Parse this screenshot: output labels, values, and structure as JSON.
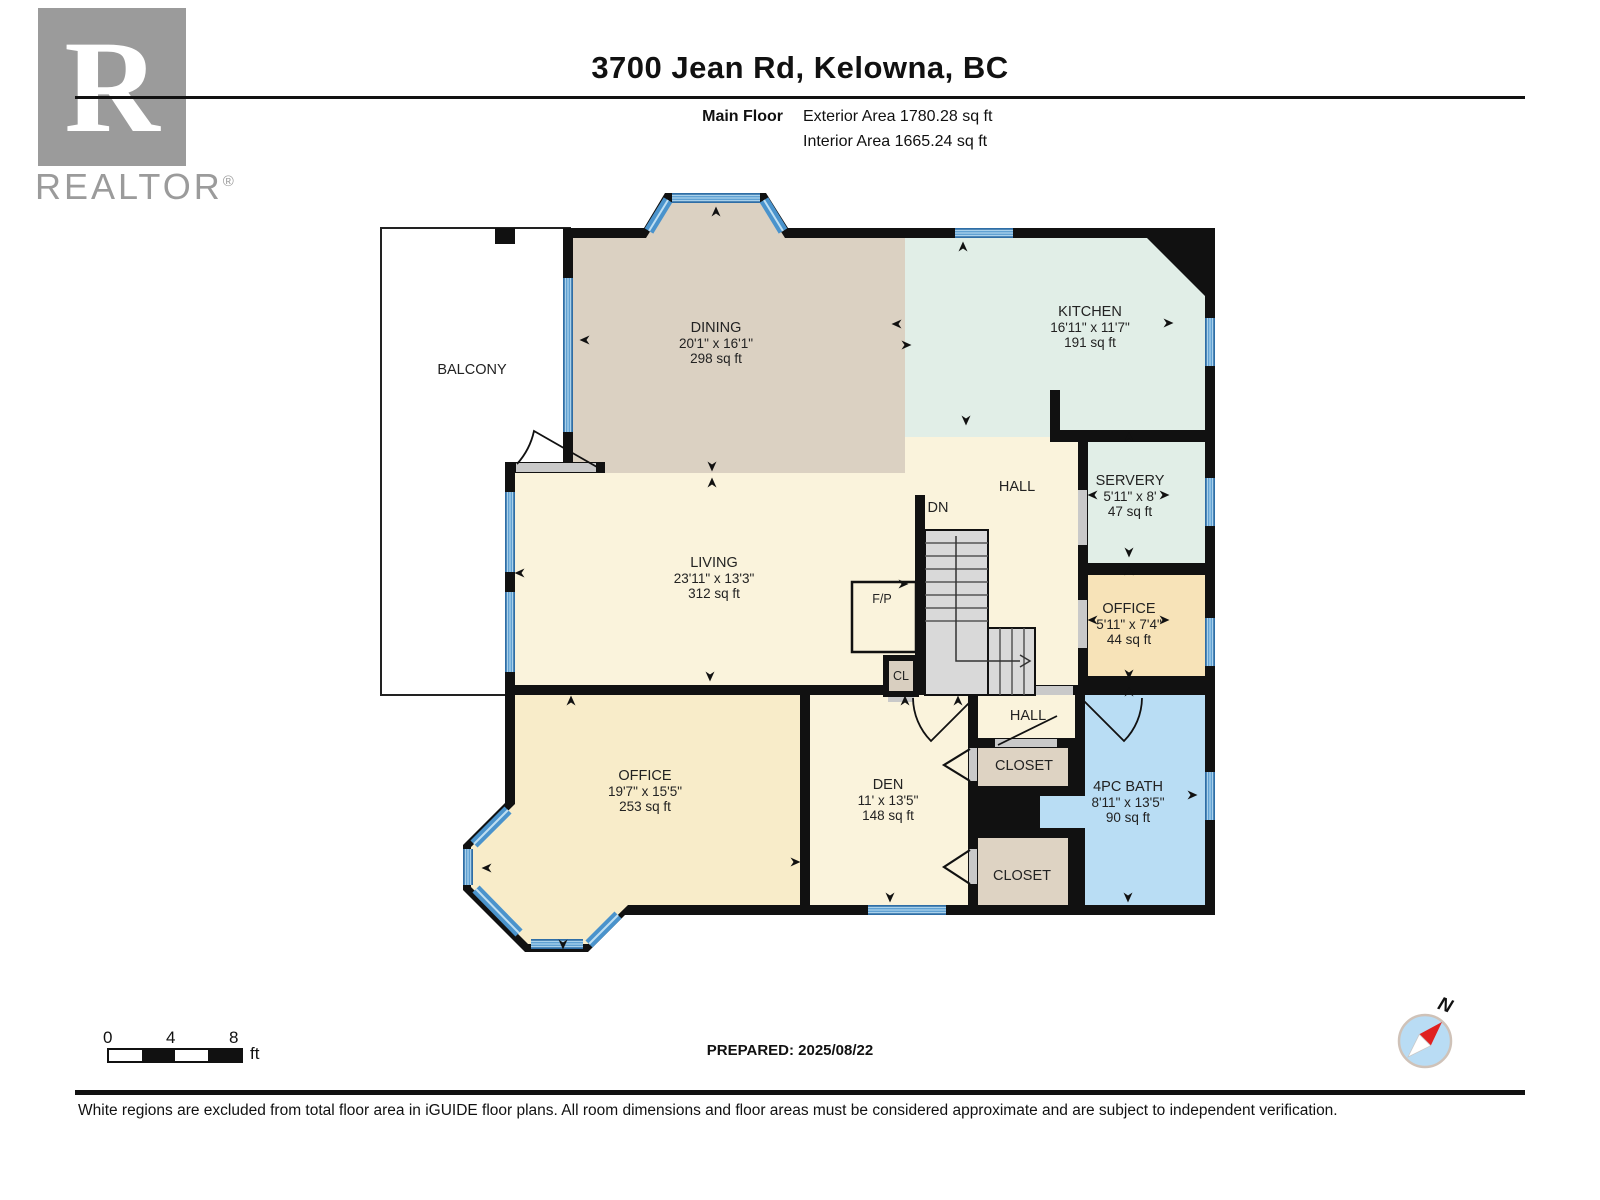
{
  "header": {
    "title": "3700 Jean Rd, Kelowna, BC",
    "floor_label": "Main Floor",
    "exterior_area": "Exterior Area 1780.28 sq ft",
    "interior_area": "Interior Area 1665.24 sq ft"
  },
  "watermark": {
    "letter": "R",
    "word": "REALTOR",
    "reg": "®"
  },
  "plan": {
    "rooms": [
      {
        "name": "BALCONY",
        "dims": "",
        "area": ""
      },
      {
        "name": "DINING",
        "dims": "20'1\" x 16'1\"",
        "area": "298 sq ft"
      },
      {
        "name": "KITCHEN",
        "dims": "16'11\" x 11'7\"",
        "area": "191 sq ft"
      },
      {
        "name": "SERVERY",
        "dims": "5'11\" x 8'",
        "area": "47 sq ft"
      },
      {
        "name": "HALL",
        "dims": "",
        "area": ""
      },
      {
        "name": "DN",
        "dims": "",
        "area": ""
      },
      {
        "name": "LIVING",
        "dims": "23'11\" x 13'3\"",
        "area": "312 sq ft"
      },
      {
        "name": "F/P",
        "dims": "",
        "area": ""
      },
      {
        "name": "OFFICE",
        "dims": "5'11\" x 7'4\"",
        "area": "44 sq ft"
      },
      {
        "name": "CL",
        "dims": "",
        "area": ""
      },
      {
        "name": "HALL",
        "dims": "",
        "area": ""
      },
      {
        "name": "CLOSET",
        "dims": "",
        "area": ""
      },
      {
        "name": "OFFICE",
        "dims": "19'7\" x 15'5\"",
        "area": "253 sq ft"
      },
      {
        "name": "DEN",
        "dims": "11' x 13'5\"",
        "area": "148 sq ft"
      },
      {
        "name": "CLOSET",
        "dims": "",
        "area": ""
      },
      {
        "name": "4PC BATH",
        "dims": "8'11\" x 13'5\"",
        "area": "90 sq ft"
      }
    ],
    "colors": {
      "wall": "#111111",
      "window_blue": "#4a93cc",
      "cream": "#faf3dc",
      "dining_tan": "#dbd1c2",
      "kitchen_mint": "#e1eee7",
      "office_yellow": "#f8ecc9",
      "office_orange": "#f7e3b8",
      "closet_tan": "#ded3c3",
      "bath_blue": "#b9ddf4",
      "stairs_gray": "#d9d9d9",
      "compass_red": "#e02020"
    }
  },
  "scalebar": {
    "t0": "0",
    "t4": "4",
    "t8": "8",
    "unit": "ft"
  },
  "prepared": "PREPARED: 2025/08/22",
  "compass": {
    "n": "N"
  },
  "footer": {
    "disclaimer": "White regions are excluded from total floor area in iGUIDE floor plans. All room dimensions and floor areas must be considered approximate and are subject to independent verification."
  }
}
